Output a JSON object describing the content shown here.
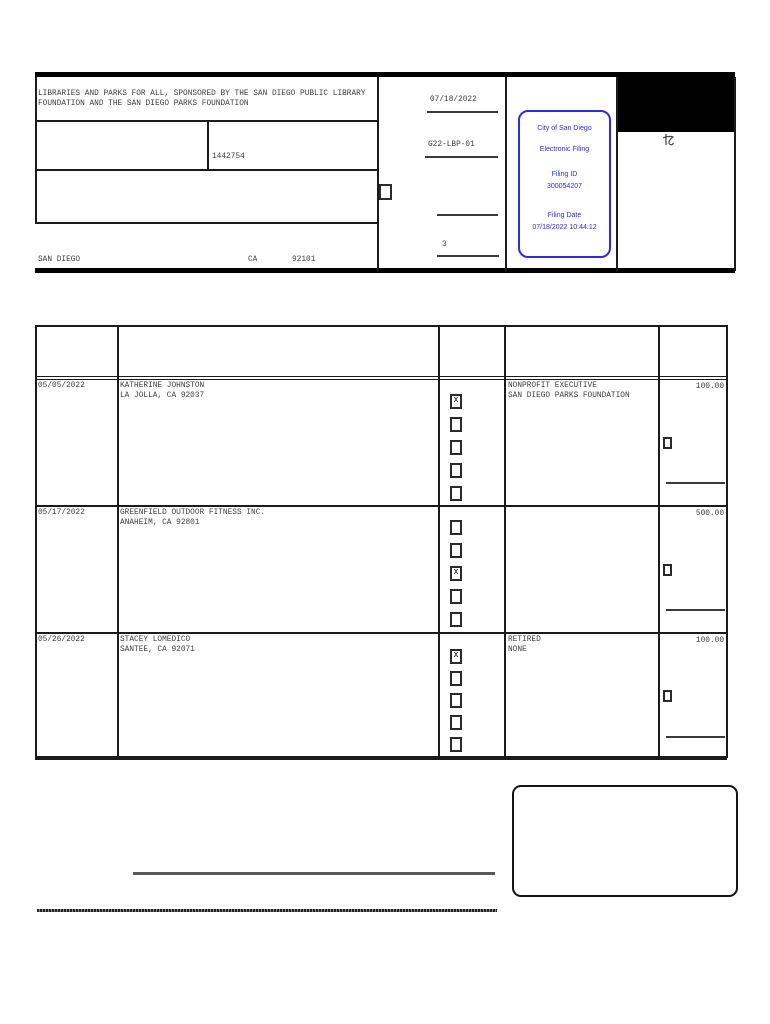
{
  "header": {
    "committee_name": "LIBRARIES AND PARKS FOR ALL, SPONSORED BY THE SAN DIEGO PUBLIC LIBRARY\nFOUNDATION AND THE SAN DIEGO PARKS FOUNDATION",
    "id_number": "1442754",
    "city": "SAN DIEGO",
    "state": "CA",
    "zip": "92101",
    "date_stamp": "07/18/2022",
    "filing_code": "G22-LBP-01",
    "page_number": "3",
    "mark_glyph": "れ"
  },
  "stamp": {
    "line1": "City of San Diego",
    "line2": "Electronic Filing",
    "filing_id_label": "Filing ID",
    "filing_id": "300054207",
    "filing_date_label": "Filing Date",
    "filing_date": "07/18/2022 10:44:12",
    "color": "#2d2de0"
  },
  "colors": {
    "line": "#1b1b1b",
    "text": "#3c3c3c",
    "stamp_blue": "#2d2de0"
  },
  "table": {
    "rows": [
      {
        "date": "05/05/2022",
        "name": "KATHERINE JOHNSTON",
        "address": "LA JOLLA, CA 92037",
        "checkboxes": [
          "X",
          "",
          "",
          "",
          ""
        ],
        "occupation": "NONPROFIT EXECUTIVE",
        "employer": "SAN DIEGO PARKS FOUNDATION",
        "amount": "100.00"
      },
      {
        "date": "05/17/2022",
        "name": "GREENFIELD OUTDOOR FITNESS INC.",
        "address": "ANAHEIM, CA 92801",
        "checkboxes": [
          "",
          "",
          "X",
          "",
          ""
        ],
        "occupation": "",
        "employer": "",
        "amount": "500.00"
      },
      {
        "date": "05/26/2022",
        "name": "STACEY LOMEDICO",
        "address": "SANTEE, CA 92071",
        "checkboxes": [
          "X",
          "",
          "",
          "",
          ""
        ],
        "occupation": "RETIRED",
        "employer": "NONE",
        "amount": "100.00"
      }
    ]
  }
}
